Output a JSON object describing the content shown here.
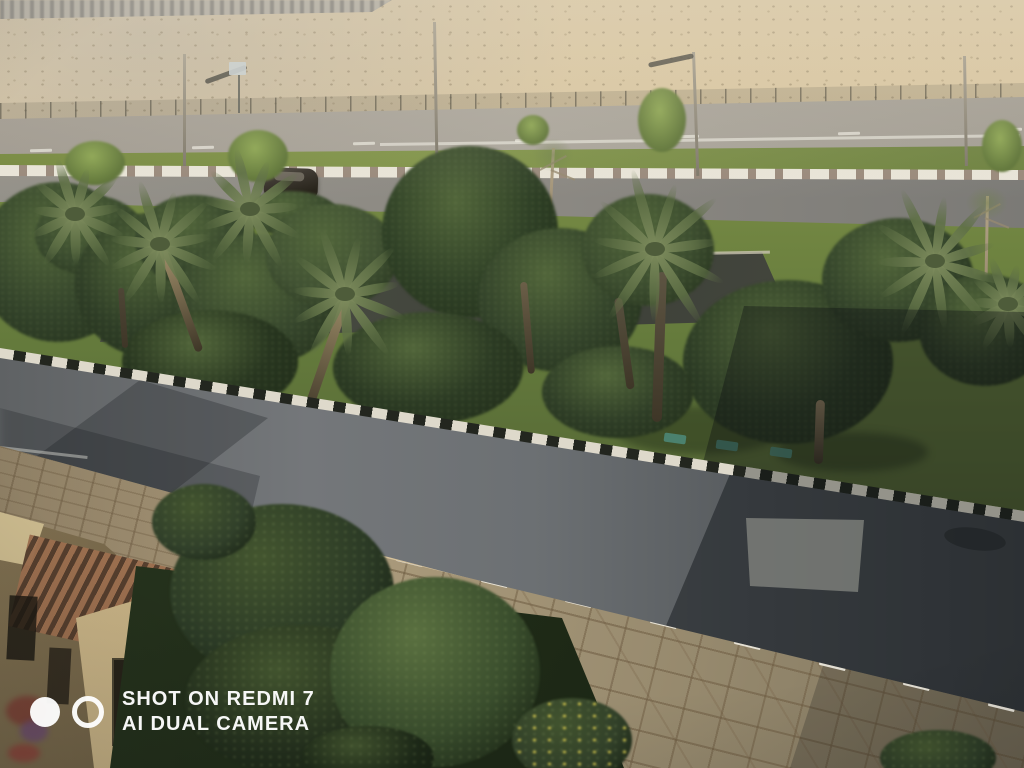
{
  "image_type": "photograph",
  "scene_description": "Elevated daytime phone photo of an empty divided street: desert hillside with chain-link fence behind, service road, landscaped palm-and-tree median with dark walkway, main road crossed by a large building shadow, flagstone sidewalk, foreground shrubs and the corner of a tan building with a pergola.",
  "watermark": {
    "line1": "SHOT ON REDMI 7",
    "line2": "AI DUAL CAMERA"
  },
  "palette": {
    "desert_sand": "#d6c29b",
    "far_road": "#a6a198",
    "grass_sunlit": "#83964a",
    "grass_shade": "#435430",
    "curb_white": "#ded9cb",
    "curb_black": "#23261f",
    "second_road": "#8b8882",
    "walkway": "#45483f",
    "tree_dark_green": "#33432a",
    "palm_frond": "#7c8c5c",
    "palm_trunk": "#a08e6a",
    "main_road": "#6b6e70",
    "road_shadow": "#3e4245",
    "sidewalk_stone": "#b2a283",
    "building_wall": "#c6b488",
    "pergola_slat": "#9c6e4e",
    "bush_dark": "#2c3b26",
    "flower_yellow": "#d8c84a",
    "car_body": "#2e2a26",
    "plaque_teal": "#4e8a7a",
    "watermark_white": "#ffffff"
  },
  "scene": {
    "poles": [
      {
        "x": 183,
        "y": 54,
        "h": 112,
        "tilt": 0
      },
      {
        "x": 433,
        "y": 22,
        "h": 138,
        "tilt": -1
      },
      {
        "x": 692,
        "y": 52,
        "h": 124,
        "tilt": -2
      },
      {
        "x": 963,
        "y": 56,
        "h": 110,
        "tilt": -1
      }
    ],
    "lamp_arms": [
      {
        "x": 204,
        "y": 72,
        "w": 44,
        "rot": -20
      },
      {
        "x": 648,
        "y": 58,
        "w": 46,
        "rot": -12
      }
    ],
    "sign": {
      "x": 229,
      "y": 62,
      "w": 17,
      "h": 13
    },
    "small_trees": [
      {
        "cx": 95,
        "cy": 163,
        "rx": 30,
        "ry": 22
      },
      {
        "cx": 258,
        "cy": 156,
        "rx": 30,
        "ry": 26
      },
      {
        "cx": 533,
        "cy": 130,
        "rx": 16,
        "ry": 15
      },
      {
        "cx": 662,
        "cy": 120,
        "rx": 24,
        "ry": 32
      },
      {
        "cx": 1002,
        "cy": 146,
        "rx": 20,
        "ry": 26
      }
    ],
    "saplings": [
      {
        "x": 552,
        "y": 148,
        "h": 112,
        "rot": 3
      },
      {
        "x": 986,
        "y": 196,
        "h": 150,
        "rot": 1
      }
    ],
    "far_dashes": {
      "x1": 30,
      "y1": 149,
      "x2": 1000,
      "y2": 128,
      "n": 7,
      "w": 22,
      "h": 3
    },
    "far_edge_line": {
      "x": 380,
      "y": 143,
      "w": 640,
      "rot": -0.8
    },
    "second_road_line": {
      "x": 540,
      "y": 228,
      "w": 490,
      "rot": 0.5
    },
    "walkway_edge": {
      "x": 120,
      "y": 262,
      "w": 650,
      "rot": -1.0
    },
    "plaques": [
      {
        "x": 664,
        "y": 434
      },
      {
        "x": 716,
        "y": 441
      },
      {
        "x": 770,
        "y": 448
      }
    ],
    "grass_shadows": [
      {
        "cx": 190,
        "cy": 332,
        "rx": 66,
        "ry": 20
      },
      {
        "cx": 482,
        "cy": 350,
        "rx": 76,
        "ry": 22
      },
      {
        "cx": 700,
        "cy": 430,
        "rx": 85,
        "ry": 24
      },
      {
        "cx": 852,
        "cy": 452,
        "rx": 76,
        "ry": 20
      }
    ],
    "trees": [
      {
        "cx": 58,
        "cy": 262,
        "rx": 80,
        "ry": 80,
        "c": "#33432a"
      },
      {
        "cx": 90,
        "cy": 235,
        "rx": 55,
        "ry": 40,
        "c": "#3a4b2e"
      },
      {
        "cx": 150,
        "cy": 285,
        "rx": 75,
        "ry": 72,
        "c": "#2e3d26"
      },
      {
        "cx": 195,
        "cy": 240,
        "rx": 60,
        "ry": 45,
        "c": "#36462c"
      },
      {
        "cx": 258,
        "cy": 300,
        "rx": 82,
        "ry": 66,
        "c": "#36462c"
      },
      {
        "cx": 290,
        "cy": 213,
        "rx": 48,
        "ry": 22,
        "c": "#3c4d2f"
      },
      {
        "cx": 332,
        "cy": 256,
        "rx": 66,
        "ry": 52,
        "c": "#415233"
      },
      {
        "cx": 470,
        "cy": 232,
        "rx": 88,
        "ry": 86,
        "c": "#2f4026"
      },
      {
        "cx": 560,
        "cy": 300,
        "rx": 82,
        "ry": 72,
        "c": "#33432a"
      },
      {
        "cx": 648,
        "cy": 250,
        "rx": 66,
        "ry": 56,
        "c": "#3c4d2f"
      },
      {
        "cx": 788,
        "cy": 362,
        "rx": 105,
        "ry": 82,
        "c": "#2b3a24"
      },
      {
        "cx": 898,
        "cy": 280,
        "rx": 76,
        "ry": 62,
        "c": "#33432a"
      },
      {
        "cx": 985,
        "cy": 330,
        "rx": 66,
        "ry": 56,
        "c": "#2e3d26"
      },
      {
        "cx": 210,
        "cy": 362,
        "rx": 88,
        "ry": 52,
        "c": "#27351f"
      },
      {
        "cx": 428,
        "cy": 368,
        "rx": 95,
        "ry": 56,
        "c": "#2b3a23"
      },
      {
        "cx": 618,
        "cy": 392,
        "rx": 76,
        "ry": 46,
        "c": "#2e3d26"
      }
    ],
    "trunks": [
      {
        "x": 158,
        "y": 248,
        "h": 110,
        "w": 8,
        "rot": -20,
        "c": "#a3916c"
      },
      {
        "x": 342,
        "y": 298,
        "h": 130,
        "w": 9,
        "rot": 19,
        "c": "#9a8a66"
      },
      {
        "x": 520,
        "y": 282,
        "h": 92,
        "w": 7,
        "rot": -5,
        "c": "#6b5f48"
      },
      {
        "x": 614,
        "y": 298,
        "h": 92,
        "w": 8,
        "rot": -8,
        "c": "#57503e"
      },
      {
        "x": 657,
        "y": 272,
        "h": 150,
        "w": 10,
        "rot": 2,
        "c": "#5d5442"
      },
      {
        "x": 816,
        "y": 400,
        "h": 64,
        "w": 9,
        "rot": 2,
        "c": "#8d7c5e"
      },
      {
        "x": 118,
        "y": 288,
        "h": 60,
        "w": 6,
        "rot": -4,
        "c": "#4e4636"
      }
    ],
    "palms": [
      {
        "cx": 75,
        "cy": 215,
        "s": 0.7
      },
      {
        "cx": 250,
        "cy": 210,
        "s": 0.75
      },
      {
        "cx": 160,
        "cy": 245,
        "s": 0.8
      },
      {
        "cx": 345,
        "cy": 295,
        "s": 0.85
      },
      {
        "cx": 655,
        "cy": 250,
        "s": 1.0
      },
      {
        "cx": 935,
        "cy": 262,
        "s": 0.95
      },
      {
        "cx": 1008,
        "cy": 305,
        "s": 0.6
      }
    ],
    "car": {
      "x": 264,
      "y": 168,
      "w": 54,
      "h": 30
    },
    "sidewalk_dashes": {
      "x1": 396,
      "y1": 559,
      "x2": 988,
      "y2": 704,
      "n": 8,
      "w": 27,
      "h": 5
    },
    "bushes": [
      {
        "cx": 282,
        "cy": 592,
        "rx": 112,
        "ry": 88,
        "c": "#2c3b26"
      },
      {
        "cx": 300,
        "cy": 700,
        "rx": 115,
        "ry": 75,
        "c": "#24301d"
      },
      {
        "cx": 435,
        "cy": 672,
        "rx": 105,
        "ry": 95,
        "c": "#3a4e2d",
        "hi": "#5a7040"
      },
      {
        "cx": 572,
        "cy": 740,
        "rx": 60,
        "ry": 42,
        "c": "#33422a",
        "flowers": true
      },
      {
        "cx": 938,
        "cy": 758,
        "rx": 58,
        "ry": 28,
        "c": "#2c3b26"
      },
      {
        "cx": 204,
        "cy": 522,
        "rx": 52,
        "ry": 38,
        "c": "#31402a"
      },
      {
        "cx": 368,
        "cy": 758,
        "rx": 66,
        "ry": 32,
        "c": "#1e2a18"
      }
    ],
    "building_blobs": [
      {
        "x": 6,
        "y": 696,
        "w": 42,
        "h": 30,
        "c": "#7a3b32"
      },
      {
        "x": 20,
        "y": 720,
        "w": 28,
        "h": 22,
        "c": "#6b4a6e"
      },
      {
        "x": 8,
        "y": 744,
        "w": 32,
        "h": 18,
        "c": "#8a4038"
      }
    ]
  }
}
